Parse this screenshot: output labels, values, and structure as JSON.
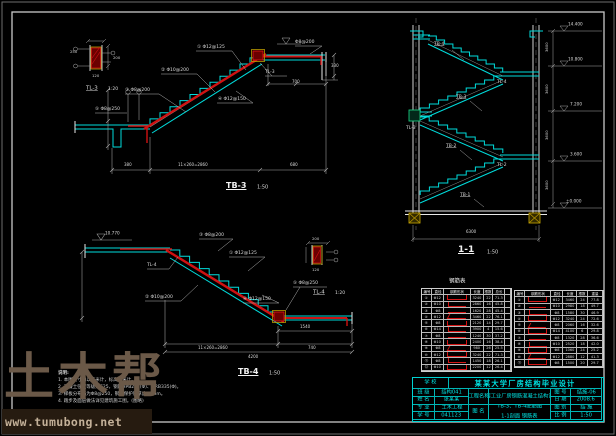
{
  "sheet": {
    "background": "#000000",
    "line_cyan": "#00dcdc",
    "line_red": "#d01212",
    "line_yellow": "#b99a00",
    "line_gray": "#c4c4c4",
    "titleblock_cyan": "#00e2e2"
  },
  "watermark": {
    "brand": "土木帮",
    "url": "www.tumubong.net"
  },
  "labels": [
    {
      "t": "TB-3",
      "x": 226,
      "y": 182,
      "s": 8,
      "c": "#f2f2f2",
      "b": 1,
      "u": 1,
      "n": "tb3-title"
    },
    {
      "t": "1:50",
      "x": 257,
      "y": 185,
      "s": 5
    },
    {
      "t": "TL-3",
      "x": 86,
      "y": 85,
      "s": 5.5,
      "u": 1,
      "n": "tl3-title"
    },
    {
      "t": "1:20",
      "x": 108,
      "y": 87,
      "s": 4.5
    },
    {
      "t": "① Φ12@125",
      "x": 197,
      "y": 45,
      "s": 4.5
    },
    {
      "t": "② Φ10@200",
      "x": 161,
      "y": 68,
      "s": 4.5
    },
    {
      "t": "③ Φ8@200",
      "x": 125,
      "y": 88,
      "s": 4.5
    },
    {
      "t": "④ Φ12@150",
      "x": 218,
      "y": 97,
      "s": 4.5
    },
    {
      "t": "⑤ Φ8@250",
      "x": 95,
      "y": 107,
      "s": 4.5
    },
    {
      "t": "Φ8@200",
      "x": 295,
      "y": 40,
      "s": 4.5
    },
    {
      "t": "TL-3",
      "x": 265,
      "y": 70,
      "s": 4.5
    },
    {
      "t": "380",
      "x": 124,
      "y": 163,
      "s": 4
    },
    {
      "t": "11×260=2860",
      "x": 178,
      "y": 163,
      "s": 4
    },
    {
      "t": "680",
      "x": 290,
      "y": 163,
      "s": 4
    },
    {
      "t": "700",
      "x": 292,
      "y": 80,
      "s": 4
    },
    {
      "t": "330",
      "x": 331,
      "y": 64,
      "s": 4
    },
    {
      "t": "250",
      "x": 70,
      "y": 50,
      "s": 3.8
    },
    {
      "t": "200",
      "x": 113,
      "y": 56,
      "s": 3.8
    },
    {
      "t": "120",
      "x": 92,
      "y": 74,
      "s": 3.8
    },
    {
      "t": "TB-4",
      "x": 238,
      "y": 368,
      "s": 8,
      "c": "#f2f2f2",
      "b": 1,
      "u": 1,
      "n": "tb4-title"
    },
    {
      "t": "1:50",
      "x": 269,
      "y": 371,
      "s": 5
    },
    {
      "t": "TL-4",
      "x": 313,
      "y": 289,
      "s": 5.5,
      "u": 1,
      "n": "tl4-title"
    },
    {
      "t": "1:20",
      "x": 335,
      "y": 291,
      "s": 4.5
    },
    {
      "t": "10.770",
      "x": 105,
      "y": 231,
      "s": 4.2
    },
    {
      "t": "③ Φ8@200",
      "x": 199,
      "y": 233,
      "s": 4.5
    },
    {
      "t": "① Φ12@125",
      "x": 229,
      "y": 251,
      "s": 4.5
    },
    {
      "t": "TL-4",
      "x": 147,
      "y": 263,
      "s": 4.5
    },
    {
      "t": "② Φ10@200",
      "x": 145,
      "y": 295,
      "s": 4.5
    },
    {
      "t": "④ Φ12@150",
      "x": 243,
      "y": 297,
      "s": 4.5
    },
    {
      "t": "⑤ Φ8@250",
      "x": 293,
      "y": 281,
      "s": 4.5
    },
    {
      "t": "11×260=2860",
      "x": 198,
      "y": 346,
      "s": 4
    },
    {
      "t": "740",
      "x": 308,
      "y": 346,
      "s": 4
    },
    {
      "t": "4200",
      "x": 248,
      "y": 355,
      "s": 4
    },
    {
      "t": "1540",
      "x": 300,
      "y": 325,
      "s": 4
    },
    {
      "t": "200",
      "x": 312,
      "y": 237,
      "s": 3.8
    },
    {
      "t": "120",
      "x": 312,
      "y": 268,
      "s": 3.8
    },
    {
      "t": "1-1",
      "x": 458,
      "y": 246,
      "s": 9,
      "c": "#f2f2f2",
      "b": 1,
      "u": 1,
      "n": "section-title"
    },
    {
      "t": "1:50",
      "x": 487,
      "y": 250,
      "s": 5
    },
    {
      "t": "TB-4",
      "x": 434,
      "y": 42,
      "s": 4.5,
      "u": 1
    },
    {
      "t": "TL-4",
      "x": 497,
      "y": 80,
      "s": 4.5
    },
    {
      "t": "TB-3",
      "x": 456,
      "y": 95,
      "s": 4.5,
      "u": 1
    },
    {
      "t": "TL-3",
      "x": 406,
      "y": 126,
      "s": 4.5
    },
    {
      "t": "TB-2",
      "x": 446,
      "y": 144,
      "s": 4.5,
      "u": 1
    },
    {
      "t": "TL-2",
      "x": 497,
      "y": 163,
      "s": 4.5
    },
    {
      "t": "TB-1",
      "x": 460,
      "y": 193,
      "s": 4.5,
      "u": 1
    },
    {
      "t": "14.400",
      "x": 568,
      "y": 22,
      "s": 4.2
    },
    {
      "t": "10.800",
      "x": 568,
      "y": 57,
      "s": 4.2
    },
    {
      "t": "7.200",
      "x": 570,
      "y": 102,
      "s": 4.2
    },
    {
      "t": "3.600",
      "x": 570,
      "y": 152,
      "s": 4.2
    },
    {
      "t": "±0.000",
      "x": 566,
      "y": 199,
      "s": 4.2
    },
    {
      "t": "3600",
      "x": 545,
      "y": 52,
      "s": 3.8,
      "r": 1
    },
    {
      "t": "3600",
      "x": 545,
      "y": 94,
      "s": 3.8,
      "r": 1
    },
    {
      "t": "3600",
      "x": 545,
      "y": 140,
      "s": 3.8,
      "r": 1
    },
    {
      "t": "3600",
      "x": 545,
      "y": 190,
      "s": 3.8,
      "r": 1
    },
    {
      "t": "6300",
      "x": 466,
      "y": 230,
      "s": 4
    },
    {
      "t": "钢筋表",
      "x": 449,
      "y": 278,
      "s": 5.5,
      "c": "#efefef",
      "n": "rebar-table-title"
    }
  ],
  "notes": {
    "heading": "说明:",
    "items": [
      "1. 本图尺寸均以毫米计，标高以米计。",
      "2. 混凝土强度等级为C25，钢筋HPB235(Φ)、HRB335(Φ)。",
      "3. 梯板分布筋为Φ8@250，钢筋保护层厚度20mm。",
      "4. 踏步及面层做法详见建筑施工图。(图略)"
    ]
  },
  "rebar_table_left": {
    "headers": [
      "编号",
      "直径",
      "钢筋形状",
      "长度",
      "根数",
      "总长",
      ""
    ],
    "rows": [
      [
        "①",
        "Φ12",
        "~1",
        "3240",
        "22",
        "71.3",
        ""
      ],
      [
        "②",
        "Φ10",
        "~2",
        "2860",
        "16",
        "45.8",
        ""
      ],
      [
        "③",
        "Φ8",
        "~0",
        "1620",
        "28",
        "45.4",
        ""
      ],
      [
        "④",
        "Φ12",
        "~3",
        "3460",
        "22",
        "76.1",
        ""
      ],
      [
        "⑤",
        "Φ8",
        "~1",
        "2120",
        "14",
        "29.7",
        ""
      ],
      [
        "⑥",
        "Φ14",
        "~2",
        "3900",
        "4",
        "15.6",
        ""
      ],
      [
        "⑦",
        "Φ8",
        "~0",
        "1240",
        "30",
        "37.2",
        ""
      ],
      [
        "⑧",
        "Φ10",
        "~1",
        "2400",
        "16",
        "38.4",
        ""
      ],
      [
        "⑨",
        "Φ8",
        "~3",
        "980",
        "26",
        "25.5",
        ""
      ],
      [
        "⑩",
        "Φ12",
        "~1",
        "3240",
        "22",
        "71.3",
        ""
      ],
      [
        "⑪",
        "Φ8",
        "~2",
        "1450",
        "18",
        "26.1",
        ""
      ],
      [
        "⑫",
        "Φ10",
        "~1",
        "2200",
        "12",
        "26.4",
        ""
      ]
    ]
  },
  "rebar_table_right": {
    "headers": [
      "编号",
      "钢筋形状",
      "直径",
      "长度",
      "根数",
      "重量"
    ],
    "rows": [
      [
        "①",
        "~1",
        "Φ12",
        "3460",
        "24",
        "77.8"
      ],
      [
        "②",
        "~0",
        "Φ10",
        "2980",
        "18",
        "49.7"
      ],
      [
        "③",
        "~2",
        "Φ8",
        "1580",
        "30",
        "46.9"
      ],
      [
        "④",
        "~1",
        "Φ12",
        "3240",
        "24",
        "72.6"
      ],
      [
        "⑤",
        "~3",
        "Φ8",
        "2060",
        "16",
        "32.6"
      ],
      [
        "⑥",
        "~1",
        "Φ14",
        "4100",
        "6",
        "29.8"
      ],
      [
        "⑦",
        "~0",
        "Φ8",
        "1320",
        "28",
        "36.6"
      ],
      [
        "⑧",
        "~2",
        "Φ10",
        "2520",
        "18",
        "42.0"
      ],
      [
        "⑨",
        "~1",
        "Φ8",
        "1060",
        "24",
        "25.2"
      ],
      [
        "⑩",
        "~3",
        "Φ12",
        "2880",
        "12",
        "41.3"
      ],
      [
        "⑪",
        "~1",
        "Φ8",
        "1500",
        "20",
        "29.7"
      ]
    ]
  },
  "title_block": {
    "school_label": "学 校",
    "title": "某某大学厂房结构毕业设计",
    "left_rows": [
      {
        "label": "班 级",
        "value": "结构041"
      },
      {
        "label": "姓 名",
        "value": "张某某"
      },
      {
        "label": "专 业",
        "value": "土木工程"
      },
      {
        "label": "学 号",
        "value": "041123"
      }
    ],
    "project_label": "工程名称",
    "project_value": "单层工业厂房钢筋混凝土结构设计",
    "drawing_label": "图 名",
    "drawing_value1": "TB-3、TB-4配筋图",
    "drawing_value2": "1-1剖面 钢筋表",
    "right_rows": [
      {
        "label": "图 号",
        "value": "结施-06"
      },
      {
        "label": "日 期",
        "value": "2008.6"
      },
      {
        "label": "图 别",
        "value": "结 施"
      },
      {
        "label": "比 例",
        "value": "1:50"
      }
    ]
  }
}
